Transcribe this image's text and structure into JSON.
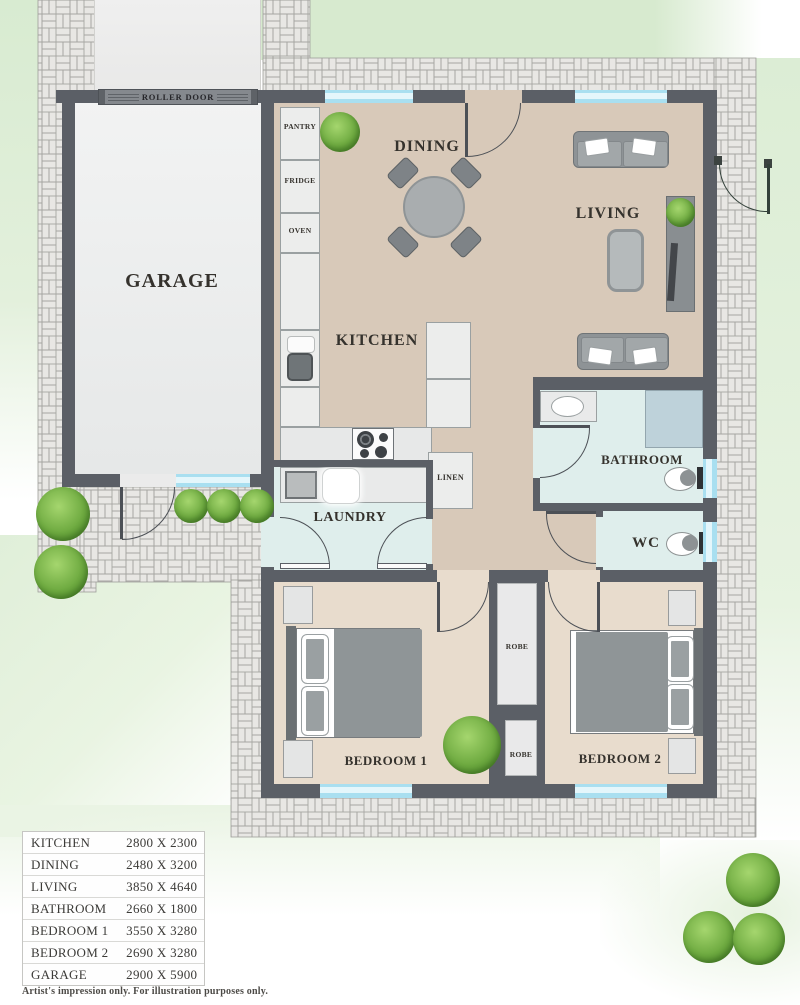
{
  "plan": {
    "labels": {
      "roller_door": "ROLLER DOOR",
      "garage": "GARAGE",
      "pantry": "PANTRY",
      "fridge": "FRIDGE",
      "oven": "OVEN",
      "dining": "DINING",
      "kitchen": "KITCHEN",
      "living": "LIVING",
      "laundry": "LAUNDRY",
      "linen": "LINEN",
      "bathroom": "BATHROOM",
      "wc": "WC",
      "robe_top": "ROBE",
      "robe_bottom": "ROBE",
      "bedroom1": "BEDROOM 1",
      "bedroom2": "BEDROOM 2"
    },
    "palette": {
      "wall": "#5b5f66",
      "floor_main": "#d8c9b9",
      "floor_bedroom": "#e8dccd",
      "floor_wet": "#dfeeec",
      "floor_shower": "#bed2da",
      "floor_garage": "#eceeee",
      "window_glass": "#a9dff0",
      "paver": "#e8e7e4",
      "paver_joint": "#a6a6a2",
      "grass": "#d9ecd2",
      "label_text": "#35322d"
    }
  },
  "dimensions": {
    "rows": [
      {
        "room": "KITCHEN",
        "size": "2800 X 2300"
      },
      {
        "room": "DINING",
        "size": "2480 X 3200"
      },
      {
        "room": "LIVING",
        "size": "3850 X 4640"
      },
      {
        "room": "BATHROOM",
        "size": "2660 X 1800"
      },
      {
        "room": "BEDROOM 1",
        "size": "3550 X 3280"
      },
      {
        "room": "BEDROOM 2",
        "size": "2690 X 3280"
      },
      {
        "room": "GARAGE",
        "size": "2900 X 5900"
      }
    ]
  },
  "footer": {
    "disclaimer": "Artist's impression only. For illustration purposes only."
  }
}
